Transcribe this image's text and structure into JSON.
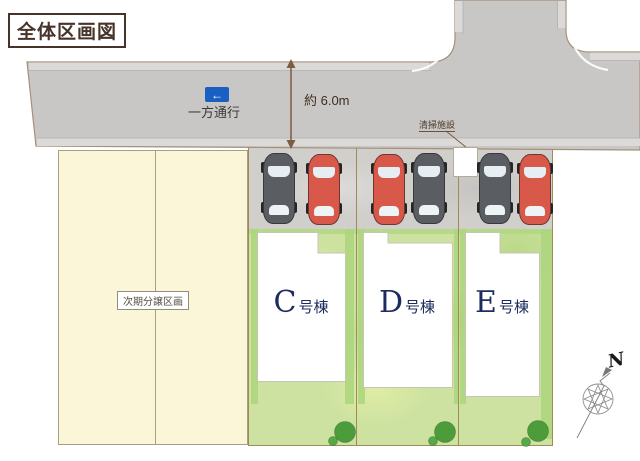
{
  "title": "全体区画図",
  "road": {
    "one_way_sign": {
      "label": "一方通行",
      "arrow_glyph": "←"
    },
    "width_annotation": "約 6.0m"
  },
  "facility_label": "清掃施設",
  "future_parcel_label": "次期分譲区画",
  "buildings": [
    {
      "letter": "C",
      "suffix": "号棟"
    },
    {
      "letter": "D",
      "suffix": "号棟"
    },
    {
      "letter": "E",
      "suffix": "号棟"
    }
  ],
  "cars": [
    {
      "lot": "C",
      "position": "left",
      "color": "gray"
    },
    {
      "lot": "C",
      "position": "right",
      "color": "red"
    },
    {
      "lot": "D",
      "position": "left",
      "color": "red"
    },
    {
      "lot": "D",
      "position": "right",
      "color": "gray"
    },
    {
      "lot": "E",
      "position": "left",
      "color": "gray"
    },
    {
      "lot": "E",
      "position": "right",
      "color": "red"
    }
  ],
  "compass_label": "N",
  "colors": {
    "road_gray": "#c9c7c5",
    "curb_light": "#dcdad8",
    "grass_green": "#cde2a0",
    "grass_accent": "#abd57d",
    "future_parcel_cream": "#fbf6d8",
    "boundary_olive": "#a08b58",
    "sign_blue": "#1a5fc2",
    "car_red": "#d8584a",
    "car_gray": "#5a5e62",
    "building_label_navy": "#1d2c5e",
    "annotation_brown": "#7b5d41"
  }
}
